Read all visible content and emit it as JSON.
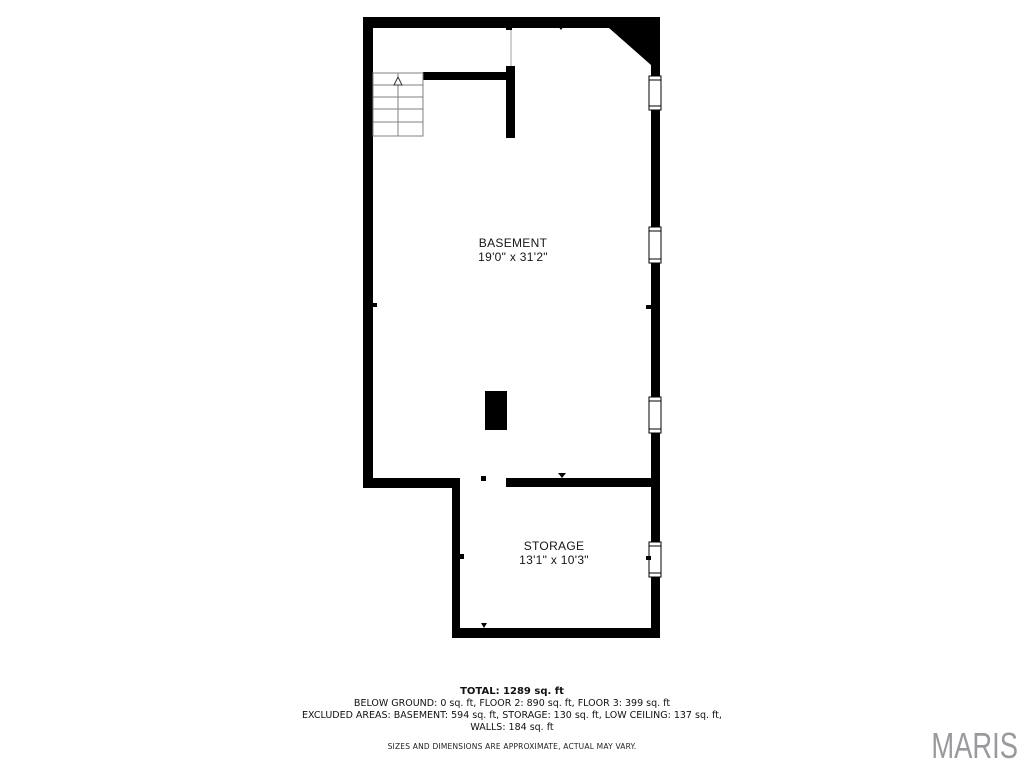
{
  "floorplan": {
    "rooms": [
      {
        "name": "BASEMENT",
        "dimensions": "19'0\" x 31'2\""
      },
      {
        "name": "STORAGE",
        "dimensions": "13'1\" x 10'3\""
      }
    ],
    "features": {
      "staircase": "stairs-up",
      "windows_on_right_wall": 4,
      "support_pillar": 1
    },
    "colors": {
      "wall": "#000000",
      "background": "#ffffff",
      "stair_line": "#808080",
      "opening_line": "#b0b0b0"
    }
  },
  "summary": {
    "total": "TOTAL: 1289 sq. ft",
    "lines": [
      "BELOW GROUND: 0 sq. ft, FLOOR 2: 890 sq. ft, FLOOR 3: 399 sq. ft",
      "EXCLUDED AREAS: BASEMENT: 594 sq. ft, STORAGE: 130 sq. ft, LOW CEILING: 137 sq. ft,",
      "WALLS: 184 sq. ft"
    ],
    "disclaimer": "SIZES AND DIMENSIONS ARE APPROXIMATE, ACTUAL MAY VARY."
  },
  "watermark": {
    "text": "MARIS",
    "color": "#9a9a9e"
  }
}
